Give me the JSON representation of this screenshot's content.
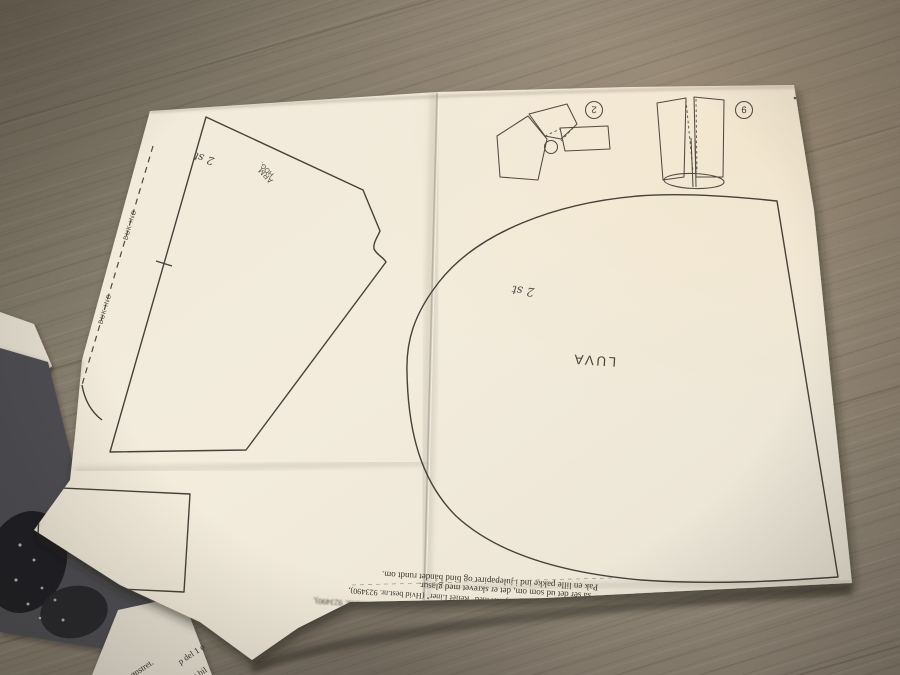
{
  "sheet": {
    "piece_labels": {
      "hood": "LUVA",
      "hood_qty": "2 st",
      "arm_top": "HÖG.",
      "arm": "ÄRM",
      "arm_qty": "2 st",
      "fold_line": "BUK IND"
    },
    "diagrams": {
      "d1_number": "2",
      "d2_number": "9"
    },
    "bottom_text": {
      "row_top": "Pak en lille pakke ind i julepapiret og bind båndet rundt om.",
      "row_mid": "så ser det ud som om, det er skrevet med glasur.",
      "row_low": "brunt. Skriv evt. god jul på hjertet med \"Relief Liner\" (Hvid best.nr. 923490),"
    }
  },
  "leaflet": {
    "fragment1": "ønstret.",
    "fragment2": "p del 1 o",
    "fragment3": "t bil"
  },
  "colors": {
    "paper": "#f2ebdb",
    "wood": "#8d8477",
    "pattern_line": "#46413a",
    "ink": "#3b342b",
    "photo_grey": "#4e4e52"
  }
}
